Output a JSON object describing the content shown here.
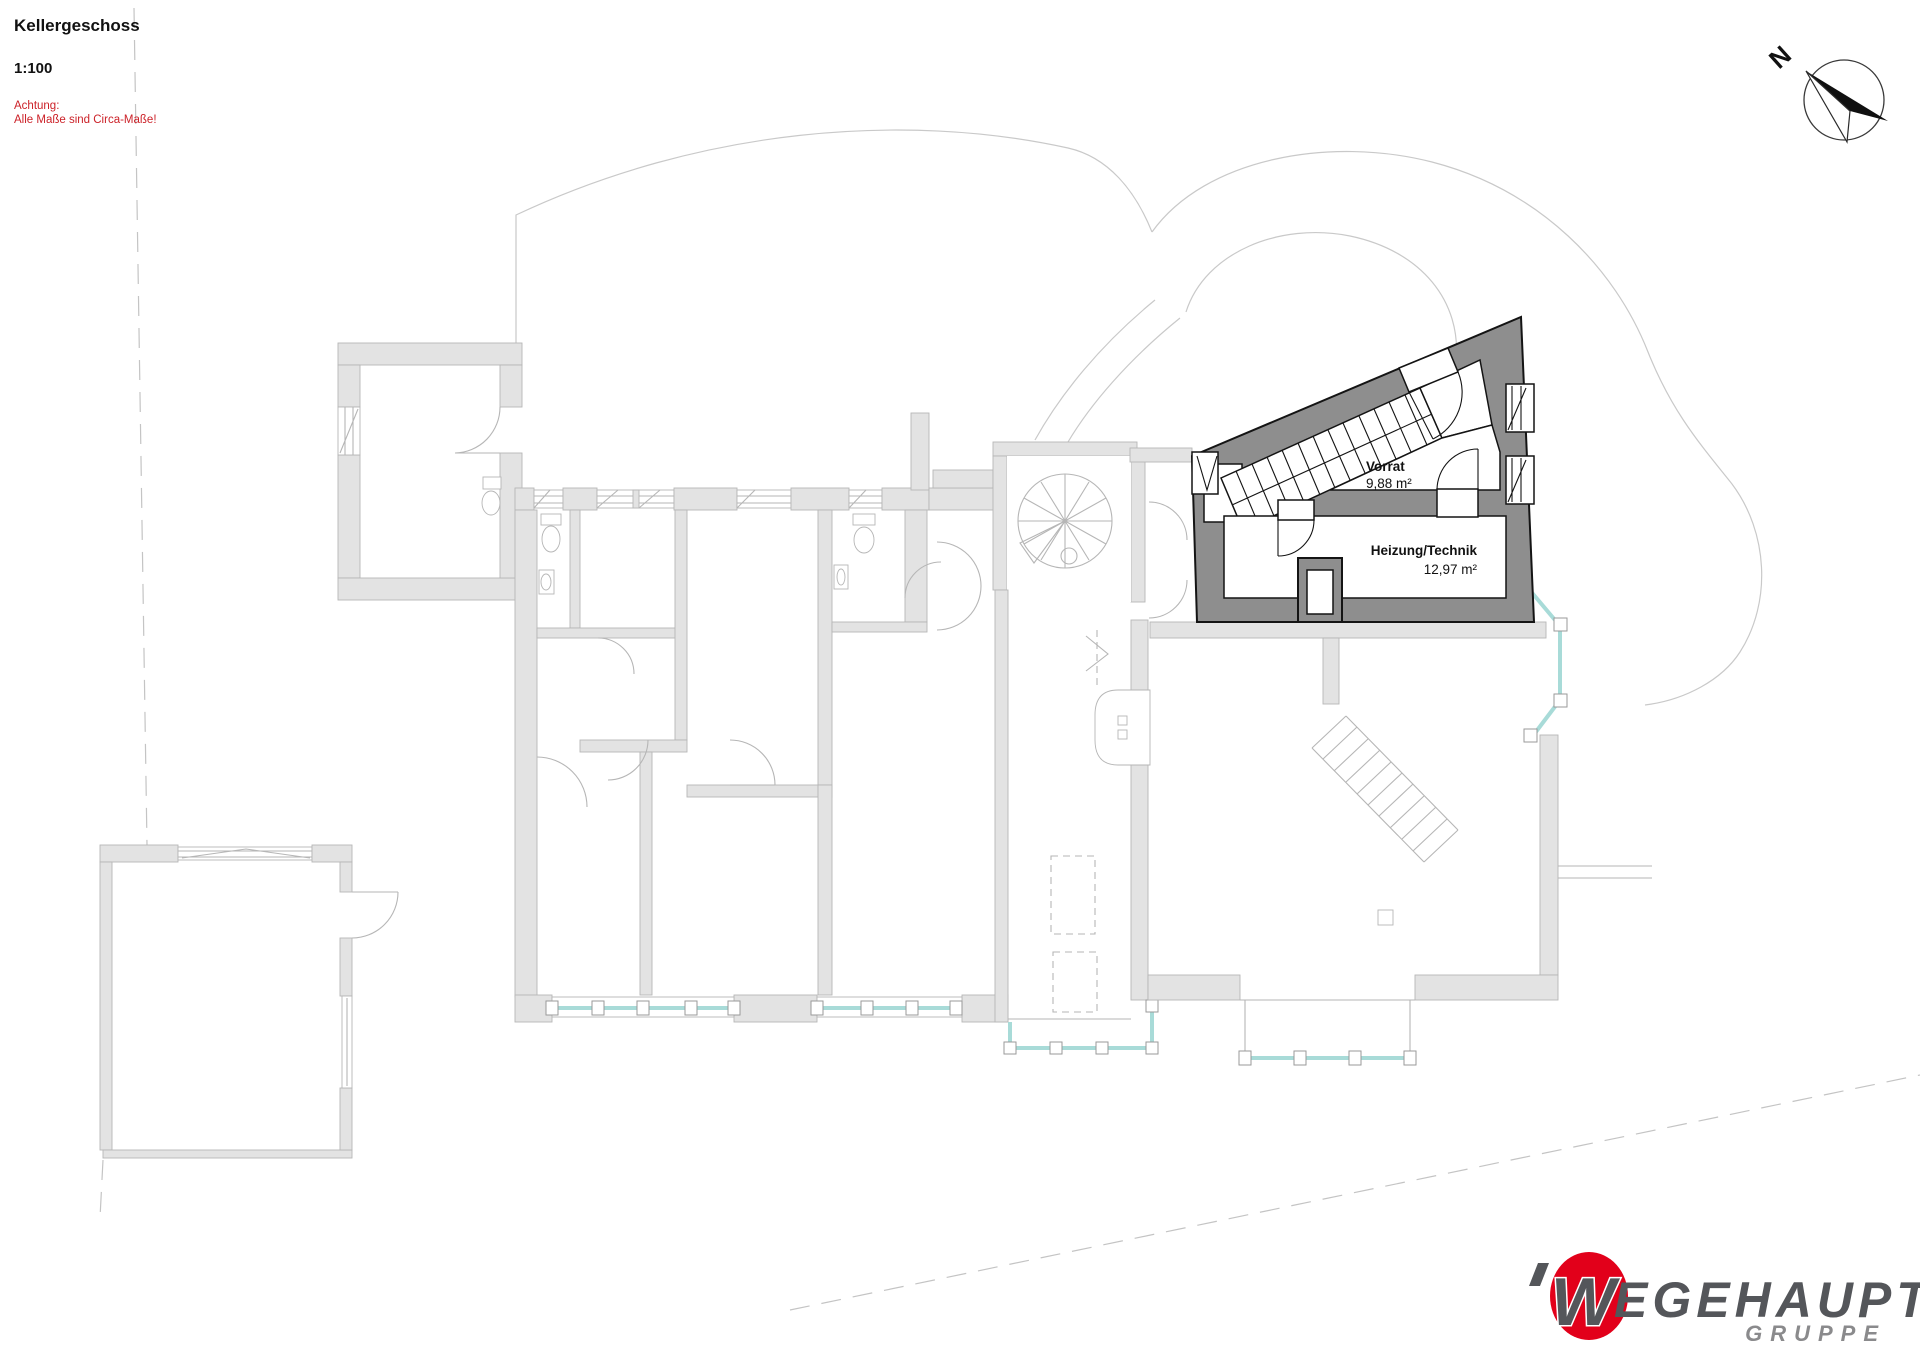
{
  "header": {
    "title": "Kellergeschoss",
    "scale": "1:100",
    "warning_line1": "Achtung:",
    "warning_line2": "Alle Maße sind Circa-Maße!"
  },
  "compass": {
    "label": "N"
  },
  "plan": {
    "floor": "Kellergeschoss",
    "rooms": [
      {
        "name": "Vorrat",
        "area": "9,88 m²"
      },
      {
        "name": "Heizung/Technik",
        "area": "12,97 m²"
      }
    ]
  },
  "logo": {
    "initial": "W",
    "word": "EGEHAUPT",
    "subtitle": "GRUPPE"
  },
  "colors": {
    "warning_red": "#cc2229",
    "highlight_wall": "#8e8e8e",
    "highlight_outline": "#141414",
    "light_wall_fill": "#e3e3e3",
    "light_wall_outline": "#b6b6b6",
    "terrain_line": "#c9c9c9",
    "glazing_teal": "#a8dbd8",
    "logo_red": "#e2001a",
    "logo_gray": "#54565a",
    "logo_subtitle_gray": "#8a8a8c"
  }
}
